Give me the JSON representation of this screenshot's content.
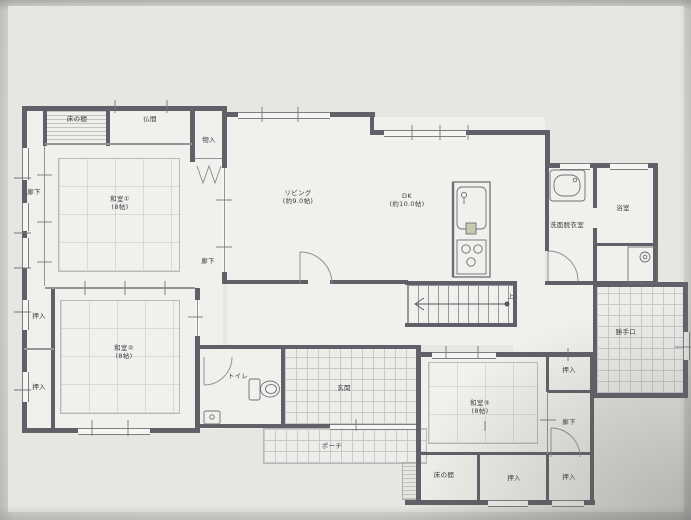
{
  "document": {
    "kind": "japanese-house-floor-plan-photo",
    "floor": "1F"
  },
  "colors": {
    "paper": "#e8e6e2",
    "wall": "#615f67",
    "thin_line": "#96949b",
    "label_text": "#3c3b42",
    "tile_line": "#cac9cc",
    "tatami_line": "#d9d8d6",
    "photo_background": "#e1dfdb"
  },
  "icons": [
    "kitchen-sink-icon",
    "stove-icon",
    "washbasin-icon",
    "washing-machine-icon",
    "toilet-icon",
    "door-swing-arc",
    "folding-door-icon",
    "stairs-up-arrow"
  ],
  "labels": {
    "tokonoma_top": "床の間",
    "butsuma": "仏間",
    "monoire": "物入",
    "rouka_left": "廊下",
    "rouka_mid": "廊下",
    "washitsu1_name": "和室①",
    "washitsu1_size": "(8帖)",
    "living_name": "リビング",
    "living_size": "(約9.0帖)",
    "dk_name": "DK",
    "dk_size": "(約10.0帖)",
    "senmen": "洗面脱衣室",
    "bath": "浴室",
    "katteguchi": "勝手口",
    "oshiire_left_top": "押入",
    "oshiire_left_bottom": "押入",
    "washitsu2_name": "和室②",
    "washitsu2_size": "(8帖)",
    "toilet": "トイレ",
    "genkan": "玄関",
    "porch": "ポーチ",
    "washitsu3_name": "和室③",
    "washitsu3_size": "(8帖)",
    "oshiire_right_top": "押入",
    "rouka_right": "廊下",
    "oshiire_right_bottom": "押入",
    "oshiire_bottom_center": "押入",
    "tokonoma_bottom": "床の間",
    "stairs_up": "上"
  }
}
